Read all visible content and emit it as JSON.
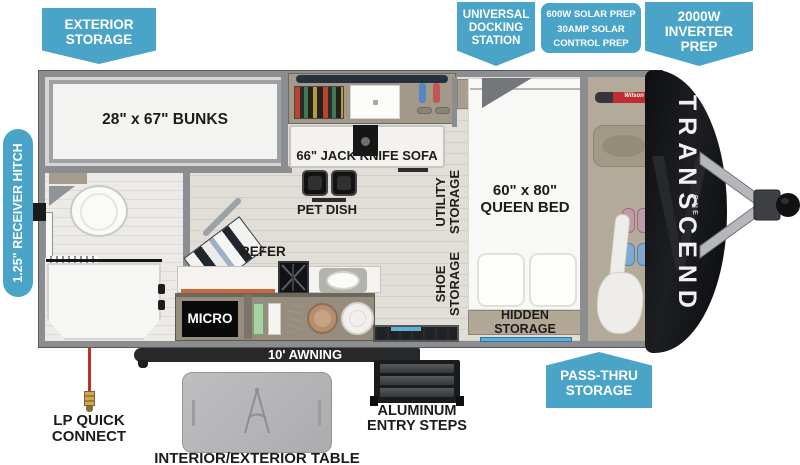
{
  "colors": {
    "callout_teal": "#4aa4c8",
    "label_dark": "#1d1c1a",
    "cap_black": "#141519",
    "awning_black": "#26282a",
    "lp_red": "#c13129"
  },
  "callouts": {
    "exterior_storage": [
      "EXTERIOR",
      "STORAGE"
    ],
    "universal_docking": [
      "UNIVERSAL",
      "DOCKING",
      "STATION"
    ],
    "solar_prep": [
      "600W SOLAR PREP",
      "30AMP SOLAR",
      "CONTROL PREP"
    ],
    "inverter_prep": [
      "2000W",
      "INVERTER",
      "PREP"
    ],
    "receiver_hitch": "1.25\" RECEIVER HITCH",
    "pass_thru_storage": [
      "PASS-THRU",
      "STORAGE"
    ]
  },
  "interior": {
    "bunks": "28\" x 67\" BUNKS",
    "sofa": "66\" JACK KNIFE SOFA",
    "pet_dish": "PET DISH",
    "utility_storage": "UTILITY STORAGE",
    "shoe_storage": "SHOE STORAGE",
    "queen_bed": [
      "60\" x 80\"",
      "QUEEN BED"
    ],
    "hidden_storage": "HIDDEN STORAGE",
    "refer": "REFER",
    "micro": "MICRO"
  },
  "exterior": {
    "awning": "10' AWNING",
    "lp_quick_connect": [
      "LP QUICK",
      "CONNECT"
    ],
    "table": "INTERIOR/EXTERIOR TABLE",
    "entry_steps": [
      "ALUMINUM",
      "ENTRY STEPS"
    ],
    "brand": "TRANSCEND",
    "brand_model": "ONE",
    "racket_brand": "Wilson"
  }
}
